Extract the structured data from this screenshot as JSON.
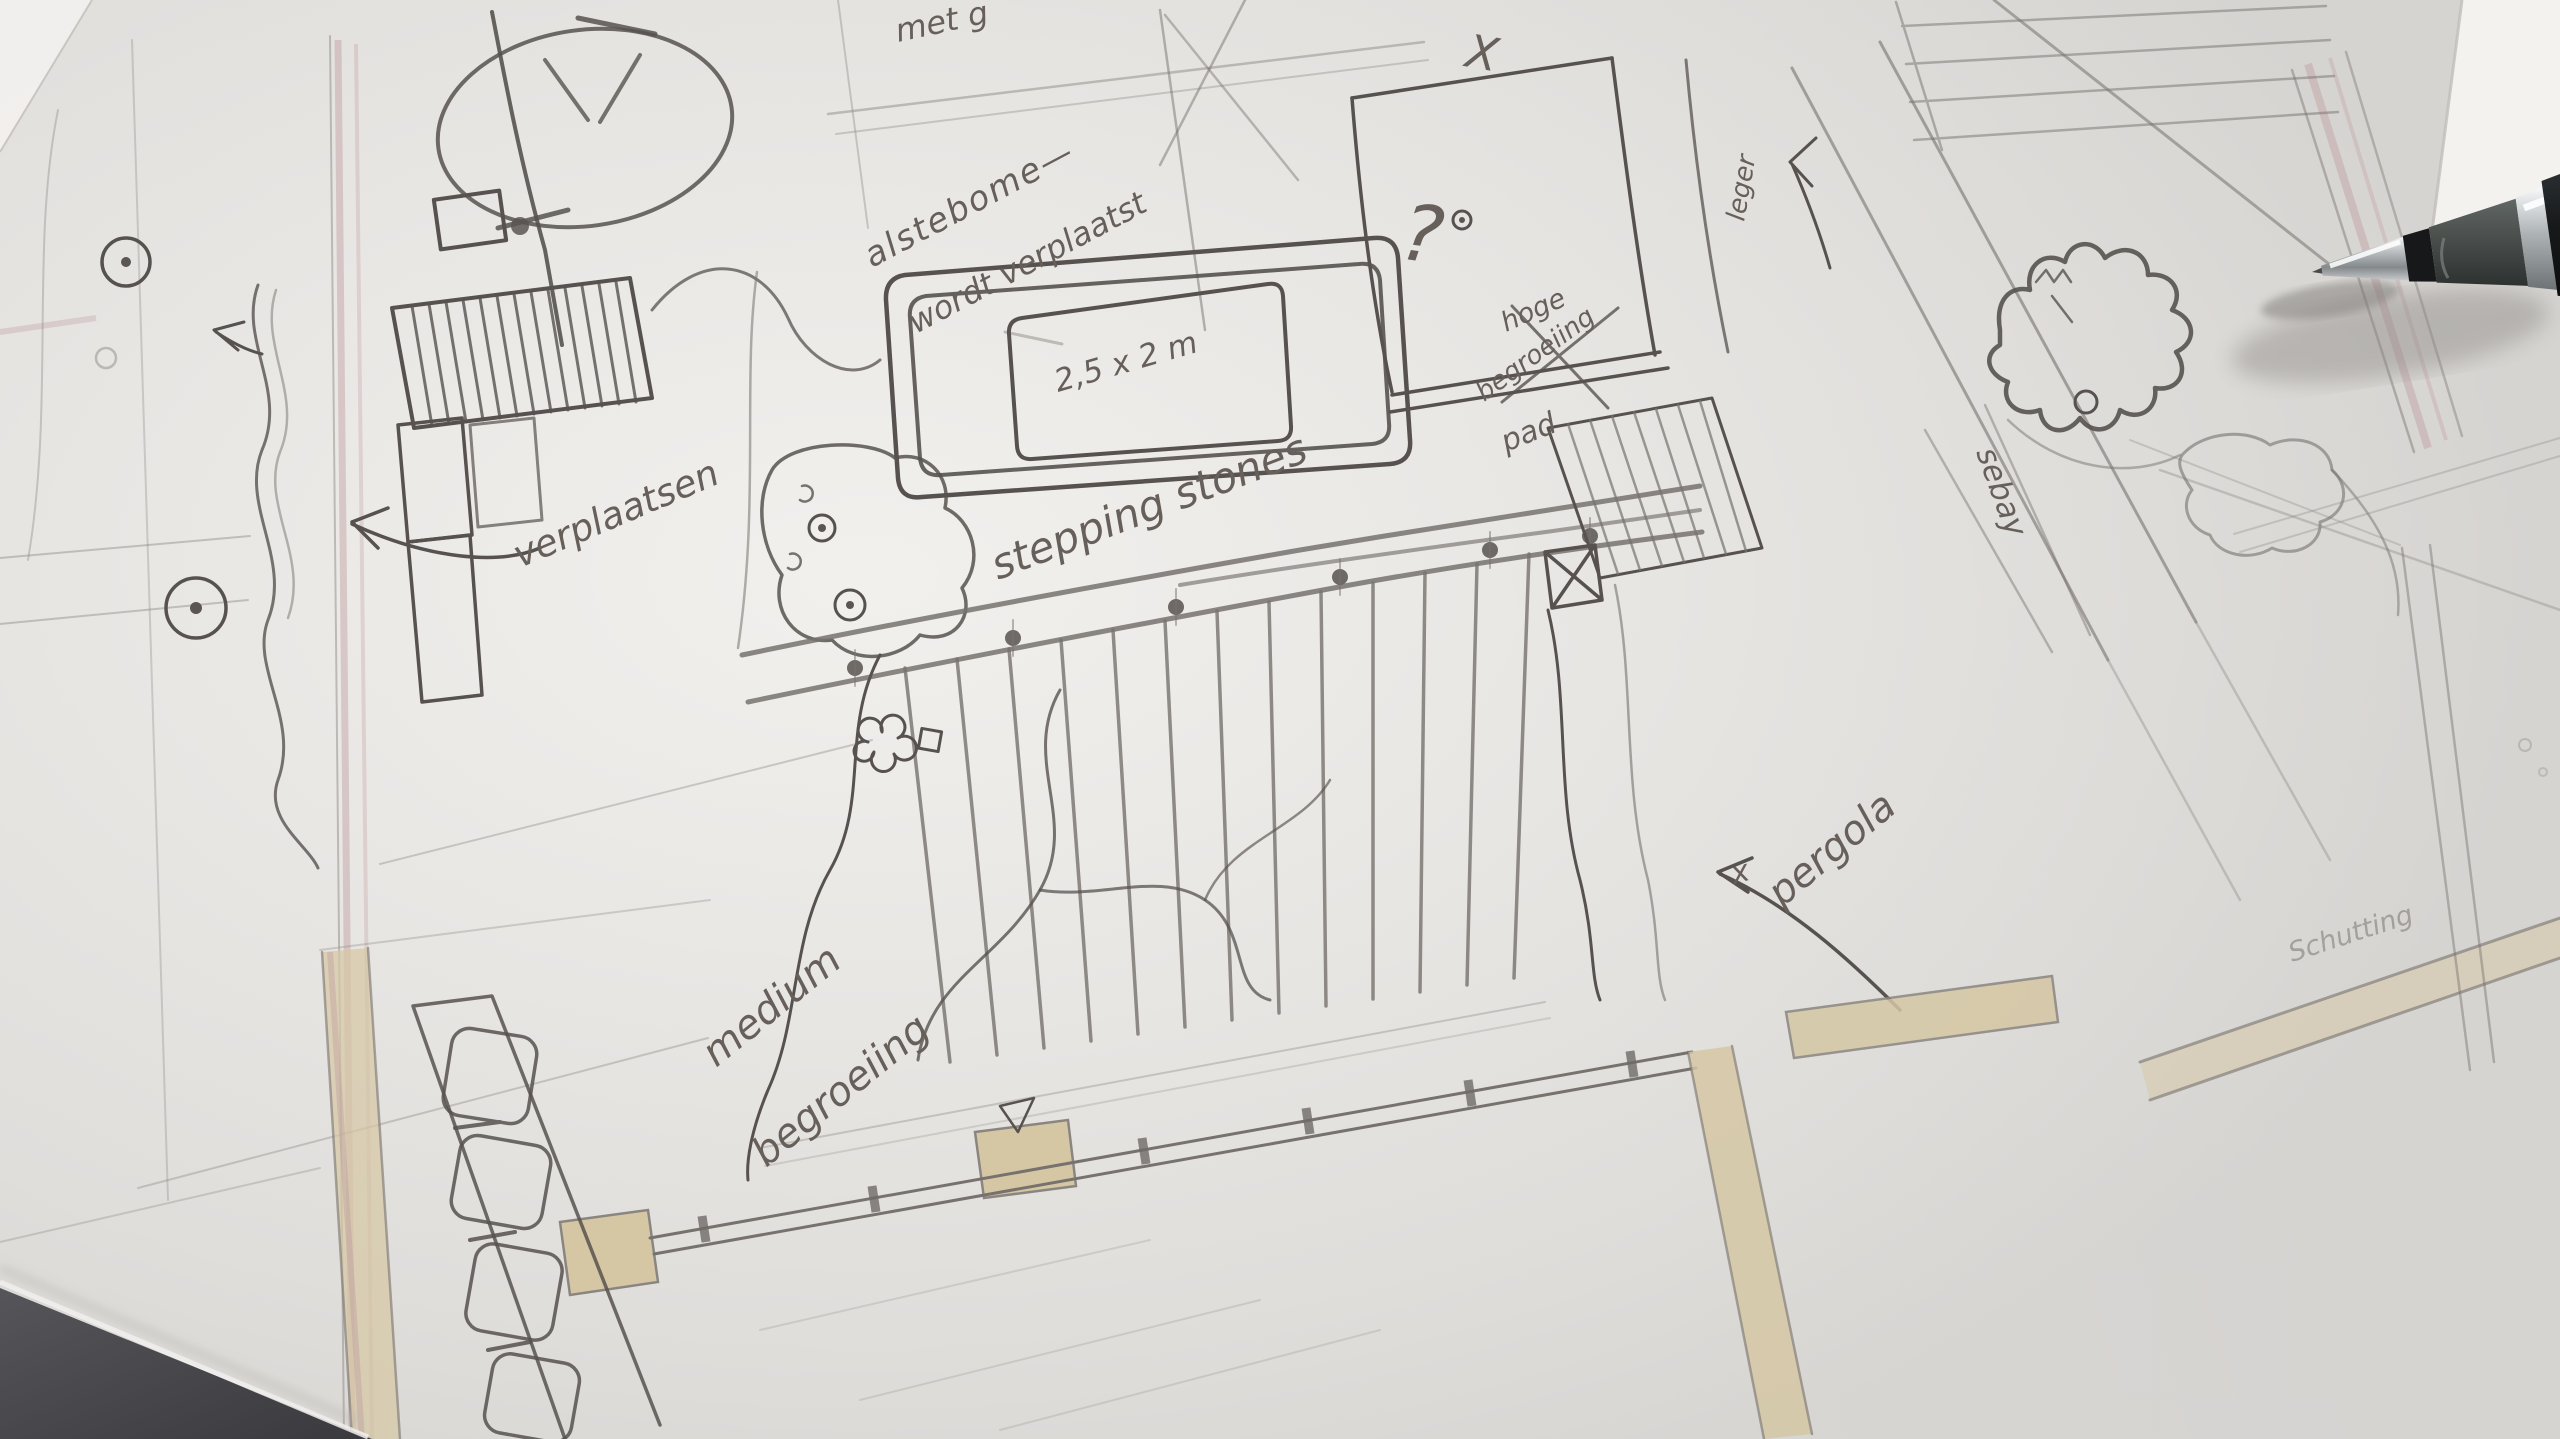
{
  "annotations": {
    "top_cutoff": "met g",
    "trees_note_line1": "alstebome—",
    "trees_note_line2": "wordt verplaatst",
    "terrace_size": "2,5 x 2 m",
    "stepping_stones": "stepping stones",
    "relocate": "verplaatsen",
    "high_planting_line1": "hoge",
    "high_planting_line2": "begroeiing",
    "path_label": "pad",
    "pergola_label": "pergola",
    "pergola_marker": "x",
    "medium_planting_line1": "medium",
    "medium_planting_line2": "begroeiing",
    "right_edge_label": "leger",
    "hedge_label": "sebay",
    "shed_label": "Schutting",
    "question_mark": "?",
    "cross_mark": "X"
  },
  "colors": {
    "paper": "#e6e4e1",
    "pencil_stroke": "#77726e",
    "handwriting": "#675f5a",
    "wall_fill": "#d5c7a4",
    "underlay_pink": "#bb9398",
    "table_dark": "#46464a",
    "sheet_white": "#f4f2ef",
    "pencil_barrel": "#1d2022",
    "pencil_grip": "#4c514f",
    "pencil_chrome": "#c8ccce"
  }
}
